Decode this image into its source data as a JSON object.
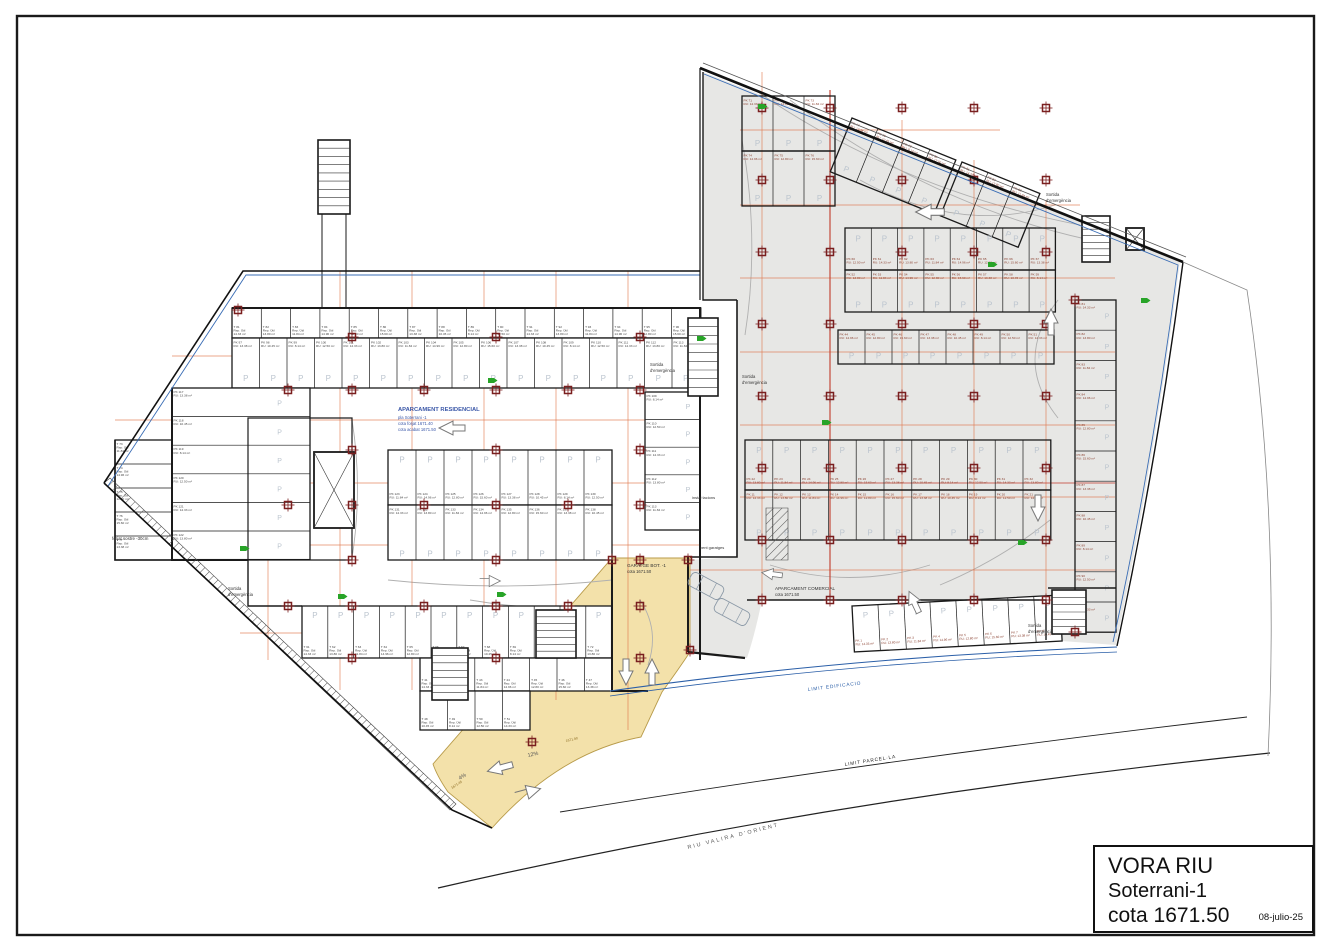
{
  "title_block": {
    "project": "VORA RIU",
    "level": "Soterrani-1",
    "cota": "cota 1671.50",
    "date": "08-julio-25"
  },
  "colors": {
    "wall": "#1a1a1a",
    "boundary_blue": "#2b5fa8",
    "commercial_fill": "#e7e7e5",
    "ramp_yellow": "#f3e1aa",
    "dim_orange": "#e0764a",
    "column_red": "#7a1f1f",
    "accent_red": "#c23b2b",
    "exit_green": "#28a428",
    "p_mark": "#bcc5cf",
    "residential_label_blue": "#3a57a8"
  },
  "area_units_pool": [
    "12.50",
    "14.33",
    "13.80",
    "11.84",
    "14.96",
    "12.80",
    "15.60",
    "13.38",
    "10.45",
    "8.14"
  ],
  "layout": {
    "frame": {
      "x": 17,
      "y": 16,
      "w": 1297,
      "h": 919,
      "sw": 2.4
    },
    "fills": [
      {
        "name": "commercial-area",
        "d": "M703,72 L1180,261 Q1156,452 1116,645 L1048,640 L1046,600 L762,600 Q755,634 747,658 L690,652 L690,560 L737,557 L737,300 L703,300 Z",
        "fill": "#e7e7e5"
      },
      {
        "name": "ramp-area-yellow",
        "d": "M433,764 L612,558 L690,558 L690,652 Q678,670 662,692 L641,737 Q560,752 492,828 L448,792 Q437,776 433,764 Z",
        "fill": "#f3e1aa",
        "stroke": "#b89b4a",
        "sw": 0.9
      }
    ],
    "hatches": [
      {
        "pts": "104,483 110,478 456,804 450,810"
      },
      {
        "pts": "766,508 788,508 788,560 766,560"
      }
    ],
    "arcs": [
      "M258,420 Q247,488 258,558",
      "M352,420 Q363,488 352,558",
      "M225,395 Q205,475 228,548",
      "M388,580 Q500,592 612,580",
      "M745,335 Q760,240 742,140",
      "M860,180 Q960,235 1055,205",
      "M1058,300 Q1012,360 1058,418",
      "M770,565 Q850,590 930,565",
      "M940,585 Q1000,560 1050,520",
      "M640,600 Q660,630 648,665",
      "M470,600 Q540,612 610,606",
      "M248,420 Q236,488 248,558",
      "M755,90 Q900,190 1080,225",
      "M790,100 Q930,205 1090,240"
    ],
    "dims_h": [
      [
        172,
        356,
        700
      ],
      [
        115,
        420,
        700
      ],
      [
        115,
        483,
        700
      ],
      [
        115,
        545,
        700
      ],
      [
        240,
        633,
        612
      ],
      [
        740,
        130,
        1000
      ],
      [
        740,
        205,
        1080
      ],
      [
        740,
        278,
        1115
      ],
      [
        740,
        352,
        1115
      ],
      [
        740,
        425,
        1115
      ],
      [
        740,
        497,
        1115
      ],
      [
        690,
        570,
        1115
      ]
    ],
    "dims_v": [
      [
        268,
        308,
        660
      ],
      [
        340,
        271,
        690
      ],
      [
        412,
        271,
        690
      ],
      [
        484,
        271,
        690
      ],
      [
        556,
        271,
        700
      ],
      [
        628,
        271,
        730
      ],
      [
        762,
        72,
        600
      ],
      [
        902,
        120,
        600
      ],
      [
        974,
        160,
        600
      ],
      [
        1046,
        200,
        640
      ]
    ],
    "accent_lines": [
      {
        "d": "M830,90 L830,600",
        "c": "#c23b2b",
        "w": 1.1
      },
      {
        "d": "M745,483 L1115,483",
        "c": "#c23b2b",
        "w": 0.8
      }
    ],
    "rows": [
      {
        "x": 232,
        "y": 308,
        "w": 29.3,
        "h": 30,
        "n": 16,
        "dir": "v",
        "pre": "T",
        "start": 81,
        "labc": "#444"
      },
      {
        "x": 232,
        "y": 338,
        "w": 27.5,
        "h": 50,
        "n": 17,
        "dir": "v",
        "pre": "PK",
        "start": 97,
        "labc": "#444",
        "p": 1,
        "ppos": 0.8
      },
      {
        "x": 172,
        "y": 388,
        "w": 138,
        "h": 28.6,
        "n": 6,
        "dir": "h",
        "pre": "PK",
        "start": 117,
        "labc": "#444",
        "p": 1
      },
      {
        "x": 115,
        "y": 440,
        "w": 57,
        "h": 24,
        "n": 5,
        "dir": "h",
        "pre": "T",
        "start": 73,
        "labc": "#444"
      },
      {
        "x": 388,
        "y": 450,
        "w": 28,
        "h": 55,
        "n": 8,
        "dir": "v",
        "pre": "PK",
        "start": 123,
        "labc": "#444",
        "p": 1,
        "ppos": 0.17
      },
      {
        "x": 388,
        "y": 505,
        "w": 28,
        "h": 55,
        "n": 8,
        "dir": "v",
        "pre": "PK",
        "start": 131,
        "labc": "#444",
        "p": 1,
        "ppos": 0.88
      },
      {
        "x": 645,
        "y": 392,
        "w": 55,
        "h": 27.6,
        "n": 5,
        "dir": "h",
        "pre": "PK",
        "start": 109,
        "labc": "#444",
        "p": 1
      },
      {
        "x": 302,
        "y": 606,
        "w": 25.8,
        "h": 52,
        "n": 12,
        "dir": "v",
        "pre": "T",
        "start": 61,
        "labc": "#444",
        "p": 1,
        "ppos": 0.17
      },
      {
        "x": 420,
        "y": 658,
        "w": 27.4,
        "h": 33,
        "n": 7,
        "dir": "v",
        "pre": "T",
        "start": 41,
        "labc": "#444"
      },
      {
        "x": 420,
        "y": 691,
        "w": 27.5,
        "h": 39,
        "n": 4,
        "dir": "v",
        "pre": "T",
        "start": 48,
        "labc": "#444"
      },
      {
        "x": 742,
        "y": 96,
        "w": 31,
        "h": 55,
        "n": 3,
        "dir": "v",
        "pre": "PK",
        "start": 71,
        "labc": "#8a4030",
        "p": 1,
        "ppos": 0.85,
        "f": "none"
      },
      {
        "x": 742,
        "y": 151,
        "w": 31,
        "h": 55,
        "n": 3,
        "dir": "v",
        "pre": "PK",
        "start": 74,
        "labc": "#8a4030",
        "p": 1,
        "ppos": 0.85,
        "f": "none"
      },
      {
        "x": 852,
        "y": 118,
        "w": 28,
        "h": 58,
        "n": 4,
        "dir": "v",
        "rot": 22,
        "pre": "PK",
        "start": 77,
        "labc": "#8a4030",
        "p": 1,
        "ppos": 0.85,
        "f": "none"
      },
      {
        "x": 962,
        "y": 162,
        "w": 28,
        "h": 58,
        "n": 3,
        "dir": "v",
        "rot": 22,
        "pre": "PK",
        "start": 81,
        "labc": "#8a4030",
        "p": 1,
        "ppos": 0.85,
        "f": "none"
      },
      {
        "x": 845,
        "y": 228,
        "w": 26.3,
        "h": 42,
        "n": 8,
        "dir": "v",
        "pre": "PK",
        "start": 60,
        "labc": "#8a4030",
        "p": 1,
        "ppos": 0.25,
        "f": "none"
      },
      {
        "x": 845,
        "y": 270,
        "w": 26.3,
        "h": 42,
        "n": 8,
        "dir": "v",
        "pre": "PK",
        "start": 52,
        "labc": "#8a4030",
        "p": 1,
        "ppos": 0.82,
        "f": "none"
      },
      {
        "x": 838,
        "y": 330,
        "w": 27,
        "h": 34,
        "n": 8,
        "dir": "v",
        "pre": "PK",
        "start": 44,
        "labc": "#8a4030",
        "p": 1,
        "ppos": 0.75,
        "f": "none"
      },
      {
        "x": 745,
        "y": 440,
        "w": 27.8,
        "h": 50,
        "n": 11,
        "dir": "v",
        "pre": "PK",
        "start": 22,
        "labc": "#8a4030",
        "p": 1,
        "ppos": 0.2,
        "f": "none"
      },
      {
        "x": 745,
        "y": 490,
        "w": 27.8,
        "h": 50,
        "n": 11,
        "dir": "v",
        "pre": "PK",
        "start": 11,
        "labc": "#8a4030",
        "p": 1,
        "ppos": 0.85,
        "f": "none"
      },
      {
        "x": 1075,
        "y": 300,
        "w": 41,
        "h": 30.2,
        "n": 11,
        "dir": "h",
        "pre": "PK",
        "start": 81,
        "labc": "#8a4030",
        "p": 1,
        "f": "none"
      },
      {
        "x": 852,
        "y": 606,
        "w": 26,
        "h": 46,
        "n": 8,
        "dir": "v",
        "rot": -3,
        "pre": "PK",
        "start": 1,
        "labc": "#8a4030",
        "p": 1,
        "ppos": 0.2,
        "f": "#fff"
      }
    ],
    "walls": [
      {
        "d": "M232,308 H700 V660",
        "w": 2
      },
      {
        "d": "M172,388 V560 H248",
        "w": 2
      },
      {
        "d": "M115,440 V560 H172",
        "w": 1.6
      },
      {
        "d": "M248,560 V606 H302",
        "w": 1.4
      },
      {
        "d": "M612,560 V691 H648",
        "w": 2
      },
      {
        "d": "M688,556 V652",
        "w": 2
      },
      {
        "d": "M737,300 V557 H690",
        "w": 1.6
      },
      {
        "d": "M703,72 V300 H737",
        "w": 1.4
      },
      {
        "d": "M747,600 H1046 V640",
        "w": 1.4
      },
      {
        "d": "M1048,588 H1116",
        "w": 1.4
      },
      {
        "d": "M322,214 V308 M346,214 V308",
        "w": 1
      },
      {
        "d": "M248,418 H352 V560 H248 Z",
        "w": 1.2
      },
      {
        "d": "M688,652 L745,658",
        "w": 2.2
      }
    ],
    "stairs": [
      {
        "x": 318,
        "y": 140,
        "w": 32,
        "h": 74,
        "n": 9
      },
      {
        "x": 688,
        "y": 318,
        "w": 30,
        "h": 78,
        "n": 9
      },
      {
        "x": 1082,
        "y": 216,
        "w": 28,
        "h": 46,
        "n": 7
      },
      {
        "x": 432,
        "y": 648,
        "w": 36,
        "h": 52,
        "n": 7
      },
      {
        "x": 536,
        "y": 610,
        "w": 40,
        "h": 48,
        "n": 7
      },
      {
        "x": 1052,
        "y": 590,
        "w": 34,
        "h": 44,
        "n": 6
      }
    ],
    "elevators": [
      {
        "x": 314,
        "y": 452,
        "w": 40,
        "h": 76
      },
      {
        "x": 1126,
        "y": 228,
        "w": 18,
        "h": 22
      }
    ],
    "columns_left": {
      "xs": [
        288,
        352,
        424,
        496,
        568,
        640
      ],
      "ys": [
        390,
        505,
        606
      ]
    },
    "columns_left2": {
      "xs": [
        352,
        496,
        640
      ],
      "ys": [
        337,
        450,
        560,
        658
      ]
    },
    "columns_right": {
      "xs": [
        762,
        830,
        902,
        974,
        1046
      ],
      "ys": [
        108,
        180,
        252,
        324,
        396,
        468,
        540,
        600
      ]
    },
    "columns_extra": [
      [
        612,
        560
      ],
      [
        688,
        560
      ],
      [
        690,
        650
      ],
      [
        532,
        742
      ],
      [
        238,
        310
      ],
      [
        1075,
        300
      ],
      [
        1075,
        632
      ]
    ],
    "boundary": [
      {
        "d": "M703,63 L1186,257",
        "c": "#555",
        "w": 0.8
      },
      {
        "d": "M700,68 L1183,262",
        "c": "#111",
        "w": 2.6
      },
      {
        "d": "M1183,262 Q1158,455 1117,646",
        "c": "#111",
        "w": 1.4
      },
      {
        "d": "M704,74 L1178,265 Q1154,455 1113,642",
        "c": "#3a6db5",
        "w": 0.9
      },
      {
        "d": "M104,483 L243,271 L700,271",
        "c": "#111",
        "w": 1.6
      },
      {
        "d": "M108,486 L246,275 L700,275",
        "c": "#3a6db5",
        "w": 0.9
      },
      {
        "d": "M104,483 L452,810 L492,828",
        "c": "#111",
        "w": 1.6
      },
      {
        "d": "M700,68 V300",
        "c": "#111",
        "w": 1.2
      },
      {
        "d": "M610,691 Q860,656 1117,647",
        "c": "#2b5fa8",
        "w": 1.1
      },
      {
        "d": "M610,696 Q860,661 1117,652",
        "c": "#2b5fa8",
        "w": 0.8
      },
      {
        "d": "M560,812 Q900,757 1247,717",
        "c": "#222",
        "w": 0.9
      },
      {
        "d": "M438,888 Q830,798 1270,753",
        "c": "#222",
        "w": 1.2
      },
      {
        "d": "M1183,262 L1247,290 Q1280,510 1268,756",
        "c": "#888",
        "w": 0.8
      }
    ],
    "arrows": [
      {
        "k": "L",
        "x": 452,
        "y": 428,
        "s": 1
      },
      {
        "k": "L",
        "x": 930,
        "y": 212,
        "s": 1.1
      },
      {
        "k": "U",
        "x": 1051,
        "y": 322,
        "s": 1
      },
      {
        "k": "D",
        "x": 1038,
        "y": 508,
        "s": 1
      },
      {
        "k": "U",
        "x": 914,
        "y": 602,
        "s": 0.9,
        "r": -25
      },
      {
        "k": "L",
        "x": 772,
        "y": 574,
        "s": 0.8,
        "r": 8
      },
      {
        "k": "R",
        "x": 490,
        "y": 581,
        "s": 0.8
      },
      {
        "k": "L",
        "x": 500,
        "y": 768,
        "s": 1,
        "r": -15
      },
      {
        "k": "R",
        "x": 528,
        "y": 792,
        "s": 1,
        "r": -15
      },
      {
        "k": "D",
        "x": 626,
        "y": 672,
        "s": 1
      },
      {
        "k": "U",
        "x": 652,
        "y": 672,
        "s": 1
      }
    ],
    "cars": [
      {
        "x": 706,
        "y": 586,
        "r": 28
      },
      {
        "x": 732,
        "y": 612,
        "r": 28
      }
    ],
    "green_markers": [
      [
        488,
        378
      ],
      [
        697,
        336
      ],
      [
        758,
        104
      ],
      [
        1018,
        540
      ],
      [
        1141,
        298
      ],
      [
        338,
        594
      ],
      [
        497,
        592
      ],
      [
        822,
        420
      ],
      [
        988,
        262
      ],
      [
        240,
        546
      ]
    ],
    "texts": [
      {
        "t": "APARCAMENT RESIDENCIAL",
        "x": 398,
        "y": 411,
        "s": 5.8,
        "c": "#3a57a8",
        "w": 700
      },
      {
        "t": "pla Soterrani -1",
        "x": 398,
        "y": 419,
        "s": 4.2,
        "c": "#3a57a8"
      },
      {
        "t": "cota forjat 1671.40",
        "x": 398,
        "y": 425,
        "s": 4.2,
        "c": "#3a57a8"
      },
      {
        "t": "cota acabat 1671.50",
        "x": 398,
        "y": 431,
        "s": 4.2,
        "c": "#3a57a8"
      },
      {
        "t": "APARCAMENT COMERCIAL",
        "x": 775,
        "y": 590,
        "s": 4.6,
        "c": "#333"
      },
      {
        "t": "cota 1671.50",
        "x": 775,
        "y": 596,
        "s": 4.2,
        "c": "#333"
      },
      {
        "t": "GARATGE BOT. -1",
        "x": 627,
        "y": 567,
        "s": 4.6,
        "c": "#333"
      },
      {
        "t": "cota 1671.50",
        "x": 627,
        "y": 573,
        "s": 4.2,
        "c": "#333"
      },
      {
        "t": "Sortida",
        "x": 650,
        "y": 366,
        "s": 4.2,
        "c": "#333"
      },
      {
        "t": "d'emergència",
        "x": 650,
        "y": 372,
        "s": 4.2,
        "c": "#333"
      },
      {
        "t": "Sortida",
        "x": 742,
        "y": 378,
        "s": 4.2,
        "c": "#333"
      },
      {
        "t": "d'emergència",
        "x": 742,
        "y": 384,
        "s": 4.2,
        "c": "#333"
      },
      {
        "t": "Sortida",
        "x": 1046,
        "y": 196,
        "s": 4.2,
        "c": "#333"
      },
      {
        "t": "d'emergència",
        "x": 1046,
        "y": 202,
        "s": 4.2,
        "c": "#333"
      },
      {
        "t": "Sortida",
        "x": 1028,
        "y": 627,
        "s": 4.2,
        "c": "#333"
      },
      {
        "t": "d'emergència",
        "x": 1028,
        "y": 633,
        "s": 4.2,
        "c": "#333"
      },
      {
        "t": "Sortida",
        "x": 228,
        "y": 590,
        "s": 4.2,
        "c": "#333"
      },
      {
        "t": "d'emergència",
        "x": 228,
        "y": 596,
        "s": 4.2,
        "c": "#333"
      },
      {
        "t": "forjat sostre -30cm",
        "x": 112,
        "y": 540,
        "s": 4.4,
        "c": "#333"
      },
      {
        "t": "instal·lacions",
        "x": 692,
        "y": 499,
        "s": 4,
        "c": "#333"
      },
      {
        "t": "vent garatges",
        "x": 700,
        "y": 549,
        "s": 4,
        "c": "#333"
      },
      {
        "t": "LIMIT EDIFICACIO",
        "x": 808,
        "y": 691,
        "s": 4.8,
        "c": "#2b5fa8",
        "r": -7,
        "ls": 0.8
      },
      {
        "t": "LIMIT PARCEL·LA",
        "x": 845,
        "y": 766,
        "s": 4.8,
        "c": "#222",
        "r": -9,
        "ls": 0.8
      },
      {
        "t": "RIU  VALIRA  D'ORIENT",
        "x": 688,
        "y": 849,
        "s": 5.4,
        "c": "#555",
        "r": -14,
        "ls": 2
      },
      {
        "t": "12%",
        "x": 528,
        "y": 757,
        "s": 5.4,
        "c": "#555",
        "r": -12
      },
      {
        "t": "4%",
        "x": 460,
        "y": 780,
        "s": 5.4,
        "c": "#555",
        "r": -33
      },
      {
        "t": "1671.90",
        "x": 566,
        "y": 742,
        "s": 3.4,
        "c": "#8a6a20",
        "r": -13
      },
      {
        "t": "1671.45",
        "x": 452,
        "y": 789,
        "s": 3.4,
        "c": "#8a6a20",
        "r": -33
      }
    ]
  }
}
